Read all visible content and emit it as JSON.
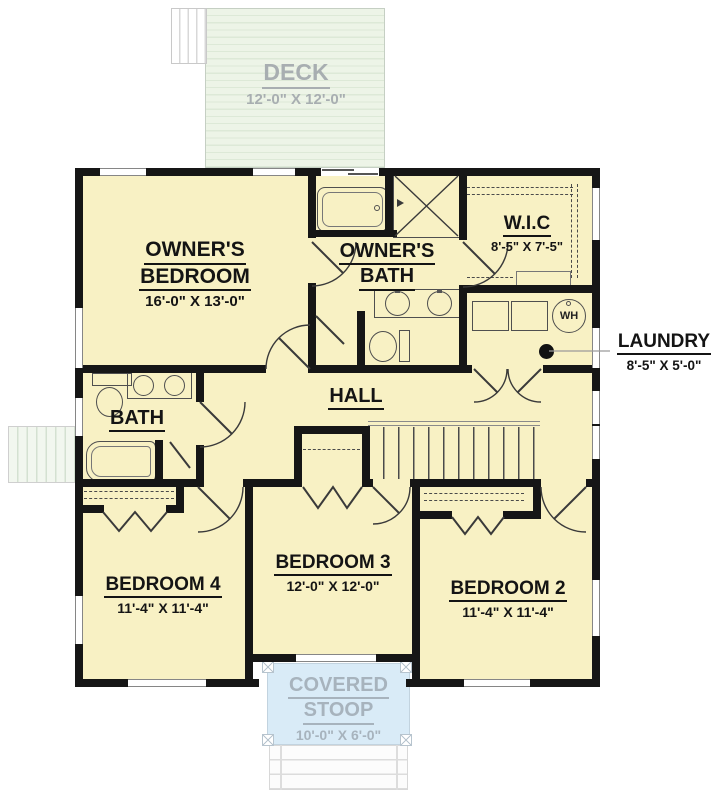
{
  "outdoor": {
    "deck": {
      "name": "DECK",
      "dims": "12'-0\" X 12'-0\""
    },
    "covered_stoop": {
      "line1": "COVERED",
      "line2": "STOOP",
      "dims": "10'-0\" X 6'-0\""
    }
  },
  "rooms": {
    "owners_bedroom": {
      "line1": "OWNER'S",
      "line2": "BEDROOM",
      "dims": "16'-0\" X 13'-0\""
    },
    "owners_bath": {
      "line1": "OWNER'S",
      "line2": "BATH"
    },
    "wic": {
      "name": "W.I.C",
      "dims": "8'-5\" X 7'-5\""
    },
    "hall": {
      "name": "HALL"
    },
    "bath": {
      "name": "BATH"
    },
    "bedroom4": {
      "name": "BEDROOM 4",
      "dims": "11'-4\" X 11'-4\""
    },
    "bedroom3": {
      "name": "BEDROOM 3",
      "dims": "12'-0\" X 12'-0\""
    },
    "bedroom2": {
      "name": "BEDROOM 2",
      "dims": "11'-4\" X 11'-4\""
    }
  },
  "callouts": {
    "laundry": {
      "name": "LAUNDRY",
      "dims": "8'-5\" X 5'-0\""
    }
  },
  "fixtures": {
    "water_heater": "WH"
  },
  "colors": {
    "wall": "#161616",
    "floor": "#f8f1c4",
    "deck": "#edf4e7",
    "stoop": "#d9ebf7",
    "outdoor_text": "#a8aeb1",
    "text": "#141414"
  }
}
